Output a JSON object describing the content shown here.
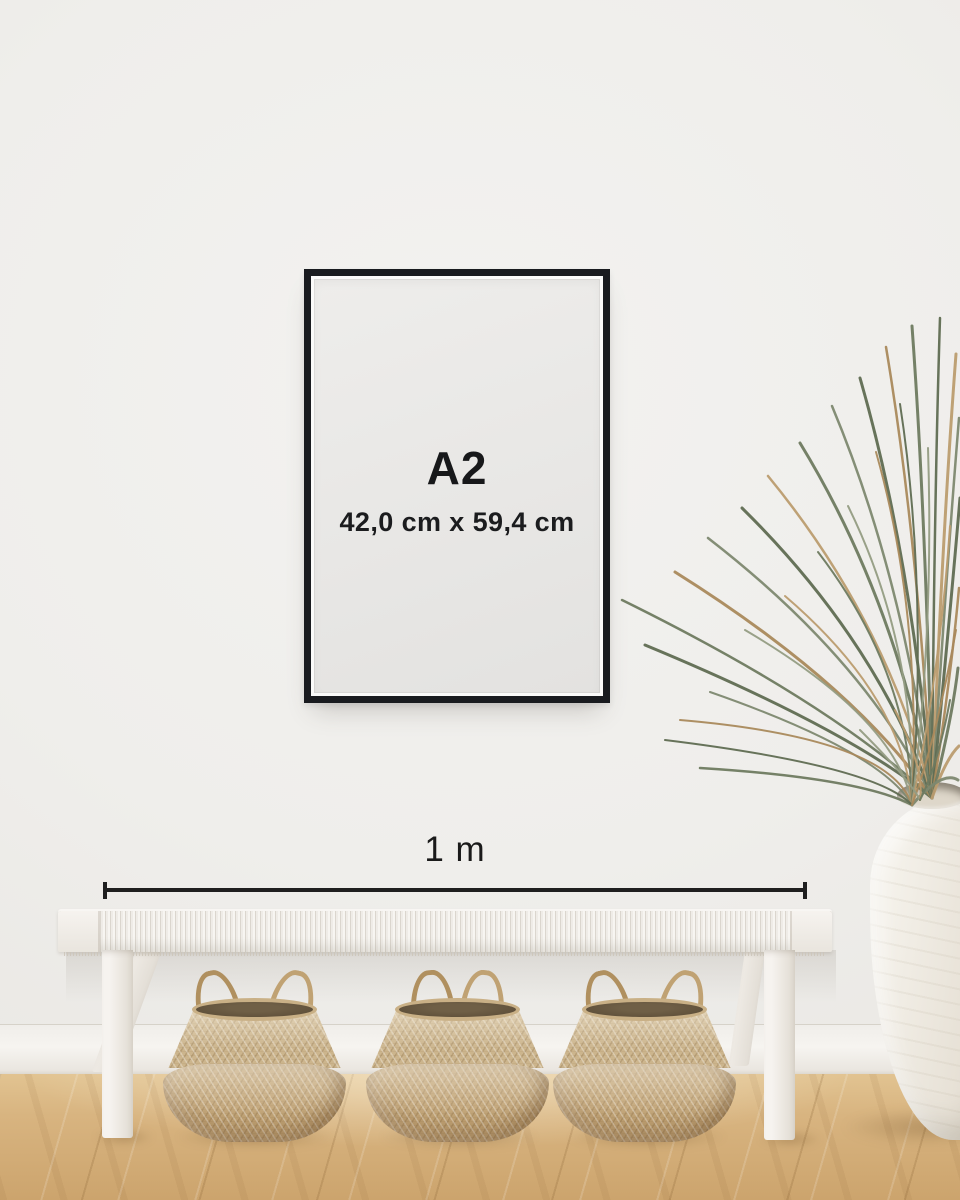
{
  "scene": {
    "poster": {
      "size_label": "A2",
      "dimensions_label": "42,0 cm x 59,4 cm"
    },
    "measurement": {
      "label": "1 m"
    },
    "colors": {
      "frame_black": "#191b1f",
      "text_black": "#17181a",
      "wall": "#efeeeb",
      "baseboard": "#f4f2ee",
      "floor_wood": "#d8b480",
      "bench_white": "#f3f0eb",
      "basket_tan": "#c0a274",
      "vase_white": "#ece7de",
      "plant_green": "#6e7a60",
      "plant_dry": "#b29064"
    }
  }
}
